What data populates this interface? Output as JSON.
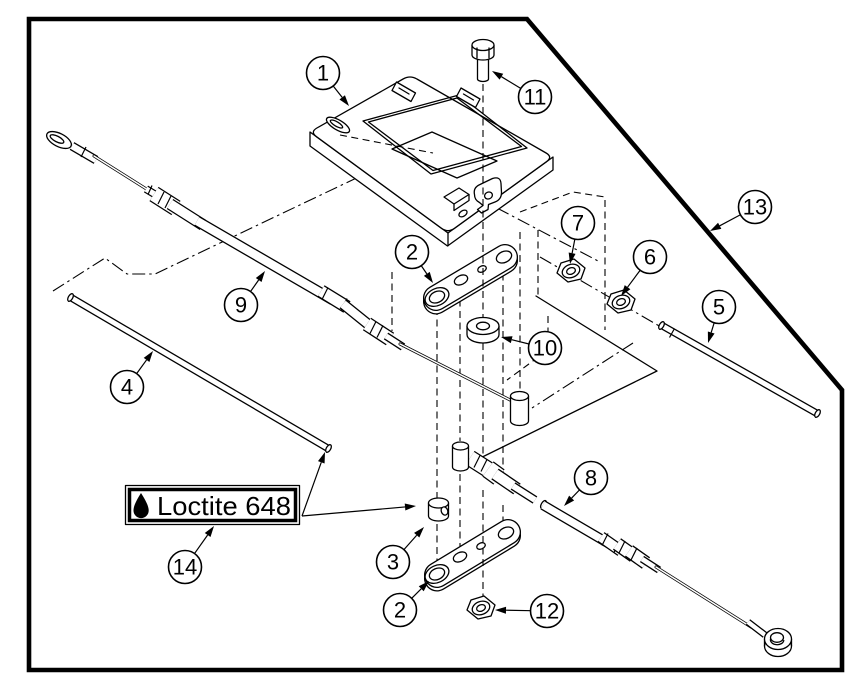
{
  "annotation_label": {
    "text": "Loctite 648",
    "icon": "droplet-icon"
  },
  "callouts": [
    {
      "number": "1",
      "cx": 323,
      "cy": 73,
      "ax": 349,
      "ay": 106
    },
    {
      "number": "11",
      "cx": 535,
      "cy": 97,
      "ax": 492,
      "ay": 71
    },
    {
      "number": "13",
      "cx": 755,
      "cy": 207,
      "ax": 710,
      "ay": 231
    },
    {
      "number": "7",
      "cx": 578,
      "cy": 223,
      "ax": 570,
      "ay": 264
    },
    {
      "number": "6",
      "cx": 650,
      "cy": 257,
      "ax": 621,
      "ay": 296
    },
    {
      "number": "2",
      "cx": 412,
      "cy": 252,
      "ax": 433,
      "ay": 283
    },
    {
      "number": "9",
      "cx": 241,
      "cy": 305,
      "ax": 265,
      "ay": 271
    },
    {
      "number": "5",
      "cx": 719,
      "cy": 307,
      "ax": 708,
      "ay": 343
    },
    {
      "number": "10",
      "cx": 545,
      "cy": 348,
      "ax": 501,
      "ay": 337
    },
    {
      "number": "4",
      "cx": 127,
      "cy": 387,
      "ax": 153,
      "ay": 351
    },
    {
      "number": "8",
      "cx": 591,
      "cy": 478,
      "ax": 564,
      "ay": 506
    },
    {
      "number": "3",
      "cx": 393,
      "cy": 562,
      "ax": 424,
      "ay": 527
    },
    {
      "number": "14",
      "cx": 185,
      "cy": 567,
      "ax": 214,
      "ay": 526
    },
    {
      "number": "2",
      "cx": 400,
      "cy": 610,
      "ax": 429,
      "ay": 581
    },
    {
      "number": "12",
      "cx": 547,
      "cy": 611,
      "ax": 495,
      "ay": 610
    }
  ],
  "colors": {
    "line": "#000000",
    "background": "#ffffff"
  }
}
